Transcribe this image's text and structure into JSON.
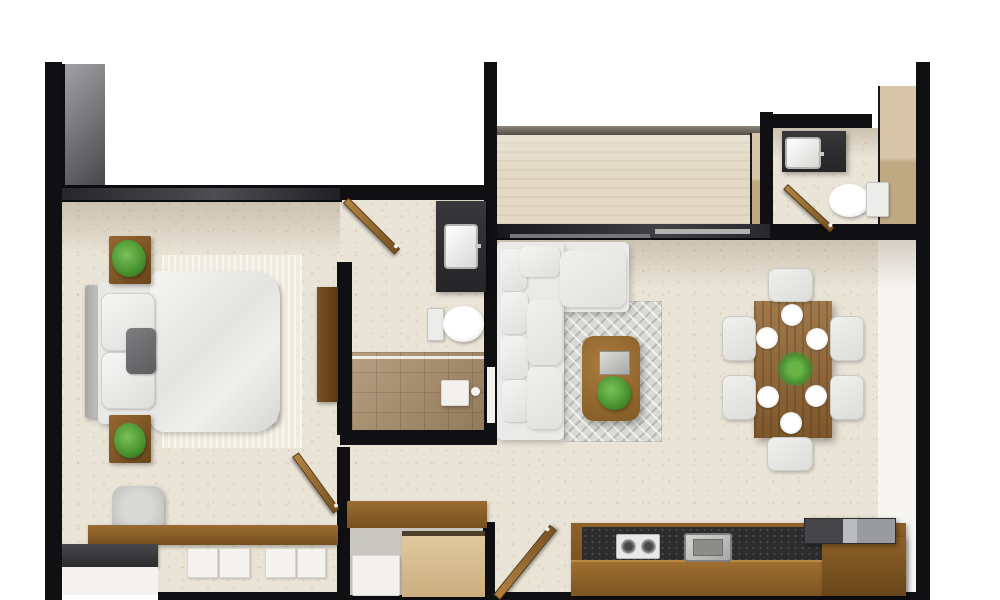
{
  "title": "apartment-floor-plan-top-view",
  "palette": {
    "background": "#ffffff",
    "wall_black": "#101013",
    "wall_gray_band": "#4d4d52",
    "floor_travertine": "#eae4d7",
    "terrace_floor": "#e3d9c6",
    "wood_door": "#a5762f",
    "wood_furniture": "#8f6229",
    "wood_cabinet_light": "#d7c19a",
    "counter_granite": "#2d2d2f",
    "vanity_charcoal": "#333336",
    "upholstery_white": "#eaeae8",
    "rug_gray": "#d9d9d5",
    "bed_rug_cream": "#f0ebdf",
    "shower_tile": "#a68b66",
    "plant_green": "#4c9632",
    "fixture_white": "#f2f1ee"
  },
  "rooms": [
    {
      "name": "bedroom",
      "contents": [
        "double-bed",
        "two-nightstands-with-plants",
        "media-console",
        "desk-with-chair",
        "drawer-unit",
        "dresser"
      ]
    },
    {
      "name": "master-bathroom",
      "contents": [
        "vanity-sink",
        "toilet",
        "walk-in-shower",
        "door"
      ]
    },
    {
      "name": "entry-corridor-closet",
      "contents": [
        "bench-console",
        "closet-cabinet",
        "storage-box",
        "entry-door",
        "bedroom-door"
      ]
    },
    {
      "name": "living-room",
      "contents": [
        "l-shaped-sofa",
        "area-rug",
        "coffee-table-with-plant-and-tray"
      ]
    },
    {
      "name": "dining-room",
      "contents": [
        "wood-table",
        "six-chairs",
        "six-plates",
        "plant-centerpiece"
      ]
    },
    {
      "name": "kitchen",
      "contents": [
        "counter-with-cooktop-and-sink",
        "appliance-block"
      ]
    },
    {
      "name": "powder-room",
      "contents": [
        "vanity-sink",
        "toilet",
        "door"
      ]
    },
    {
      "name": "terrace",
      "contents": []
    }
  ],
  "floorplan": {
    "canvas": {
      "width": 1000,
      "height": 600
    },
    "items": [
      {
        "name": "bedroom-floor",
        "cls": "floor",
        "rect": [
          62,
          195,
          278,
          400
        ]
      },
      {
        "name": "corridor-floor",
        "cls": "floor",
        "rect": [
          340,
          195,
          157,
          400
        ]
      },
      {
        "name": "living-floor",
        "cls": "floor",
        "rect": [
          497,
          235,
          421,
          360
        ]
      },
      {
        "name": "terrace-floor",
        "cls": "terrace",
        "rect": [
          497,
          133,
          263,
          94
        ]
      },
      {
        "name": "powder-floor",
        "cls": "floor",
        "rect": [
          772,
          128,
          106,
          100
        ]
      },
      {
        "name": "powder-right-panel",
        "cls": "panel-wood",
        "rect": [
          878,
          86,
          38,
          148
        ]
      },
      {
        "name": "entry-floor",
        "cls": "whitefloor",
        "rect": [
          878,
          234,
          38,
          360
        ]
      },
      {
        "name": "bedroom-wall-shade",
        "cls": "shade",
        "rect": [
          62,
          202,
          278,
          55
        ]
      },
      {
        "name": "living-wall-shade",
        "cls": "shade",
        "rect": [
          497,
          239,
          421,
          50
        ]
      },
      {
        "name": "powder-wall-shade",
        "cls": "shade",
        "rect": [
          772,
          128,
          106,
          30
        ]
      },
      {
        "name": "left-wall",
        "cls": "wall",
        "rect": [
          45,
          62,
          17,
          538
        ]
      },
      {
        "name": "wardrobe-gray-panel",
        "cls": "graypanel",
        "rect": [
          62,
          64,
          43,
          126
        ]
      },
      {
        "name": "bedroom-top-wall",
        "cls": "wallband",
        "rect": [
          62,
          185,
          280,
          17
        ]
      },
      {
        "name": "bath-top-wall",
        "cls": "wall",
        "rect": [
          340,
          185,
          157,
          15
        ]
      },
      {
        "name": "center-wall",
        "cls": "wall",
        "rect": [
          484,
          62,
          13,
          383
        ]
      },
      {
        "name": "wall-niche",
        "cls": "niche",
        "rect": [
          487,
          367,
          8,
          56
        ]
      },
      {
        "name": "terrace-parapet",
        "cls": "parapet",
        "rect": [
          497,
          126,
          263,
          9
        ]
      },
      {
        "name": "terrace-right-wood",
        "cls": "panel-wood",
        "rect": [
          750,
          133,
          10,
          94
        ]
      },
      {
        "name": "terrace-right-wall",
        "cls": "wall",
        "rect": [
          760,
          112,
          13,
          125
        ]
      },
      {
        "name": "living-top-wall",
        "cls": "wallband2",
        "rect": [
          497,
          224,
          273,
          16
        ]
      },
      {
        "name": "window-line-1",
        "cls": "winline",
        "rect": [
          655,
          229,
          95,
          5
        ]
      },
      {
        "name": "window-line-2",
        "cls": "winline2",
        "rect": [
          510,
          234,
          140,
          4
        ]
      },
      {
        "name": "powder-top-wall",
        "cls": "wall",
        "rect": [
          770,
          114,
          102,
          14
        ]
      },
      {
        "name": "powder-bottom-wall",
        "cls": "wall",
        "rect": [
          770,
          224,
          160,
          16
        ]
      },
      {
        "name": "right-wall",
        "cls": "wall",
        "rect": [
          916,
          62,
          14,
          538
        ]
      },
      {
        "name": "bottom-wall",
        "cls": "wall",
        "rect": [
          158,
          592,
          772,
          8
        ]
      },
      {
        "name": "bath-left-wall",
        "cls": "wall",
        "rect": [
          337,
          262,
          15,
          173
        ]
      },
      {
        "name": "bath-bottom-wall",
        "cls": "wall",
        "rect": [
          340,
          430,
          157,
          15
        ]
      },
      {
        "name": "corridor-pillar",
        "cls": "wall",
        "rect": [
          337,
          447,
          13,
          78
        ]
      },
      {
        "name": "closet-left-wall",
        "cls": "wall",
        "rect": [
          337,
          522,
          13,
          78
        ]
      },
      {
        "name": "closet-right-wall",
        "cls": "wall",
        "rect": [
          482,
          522,
          13,
          78
        ]
      },
      {
        "name": "shower-floor",
        "cls": "shower",
        "rect": [
          352,
          352,
          132,
          78
        ]
      },
      {
        "name": "shower-glass",
        "cls": "glass",
        "rect": [
          352,
          356,
          132,
          3
        ]
      },
      {
        "name": "shower-seat",
        "cls": "whiteobj",
        "rect": [
          441,
          380,
          28,
          26
        ]
      },
      {
        "name": "shower-knob",
        "cls": "dot-white",
        "rect": [
          471,
          387,
          9,
          9
        ]
      },
      {
        "name": "bath-vanity",
        "cls": "darkunit",
        "rect": [
          436,
          201,
          50,
          91
        ]
      },
      {
        "name": "bath-sink",
        "cls": "sink",
        "rect": [
          444,
          224,
          34,
          45
        ]
      },
      {
        "name": "bath-toilet-tank",
        "cls": "tank",
        "rect": [
          427,
          308,
          17,
          33
        ]
      },
      {
        "name": "bath-toilet-bowl",
        "cls": "bowl",
        "rect": [
          443,
          306,
          41,
          36
        ]
      },
      {
        "name": "bed-rug",
        "cls": "bedrug",
        "rect": [
          162,
          255,
          140,
          193
        ]
      },
      {
        "name": "bed-headboard",
        "cls": "headboard",
        "rect": [
          85,
          285,
          15,
          133
        ]
      },
      {
        "name": "bed-mattress",
        "cls": "mattress",
        "rect": [
          98,
          282,
          180,
          142
        ]
      },
      {
        "name": "bed-duvet",
        "cls": "duvet",
        "rect": [
          150,
          271,
          130,
          161
        ]
      },
      {
        "name": "bed-pillow-1",
        "cls": "pillow",
        "rect": [
          101,
          293,
          54,
          58
        ]
      },
      {
        "name": "bed-pillow-2",
        "cls": "pillow",
        "rect": [
          101,
          352,
          54,
          57
        ]
      },
      {
        "name": "bed-accent-pillow",
        "cls": "pillow-gray",
        "rect": [
          126,
          328,
          30,
          46
        ]
      },
      {
        "name": "nightstand-top",
        "cls": "nstand",
        "rect": [
          109,
          236,
          42,
          48
        ]
      },
      {
        "name": "plant-top",
        "cls": "plant",
        "rect": [
          112,
          240,
          34,
          37
        ]
      },
      {
        "name": "nightstand-bottom",
        "cls": "nstand",
        "rect": [
          109,
          415,
          42,
          48
        ]
      },
      {
        "name": "plant-bottom",
        "cls": "plant",
        "rect": [
          114,
          423,
          32,
          35
        ]
      },
      {
        "name": "media-console",
        "cls": "console",
        "rect": [
          317,
          287,
          21,
          115
        ]
      },
      {
        "name": "bedroom-chair",
        "cls": "chair-gray",
        "rect": [
          112,
          486,
          52,
          49
        ]
      },
      {
        "name": "bedroom-desk",
        "cls": "wood-desk",
        "rect": [
          88,
          525,
          250,
          20
        ]
      },
      {
        "name": "drawer-1",
        "cls": "drawer",
        "rect": [
          187,
          548,
          31,
          30
        ]
      },
      {
        "name": "drawer-2",
        "cls": "drawer",
        "rect": [
          219,
          548,
          31,
          30
        ]
      },
      {
        "name": "drawer-3",
        "cls": "drawer",
        "rect": [
          265,
          548,
          31,
          30
        ]
      },
      {
        "name": "drawer-4",
        "cls": "drawer",
        "rect": [
          297,
          548,
          29,
          30
        ]
      },
      {
        "name": "dresser-top",
        "cls": "darktop",
        "rect": [
          62,
          544,
          96,
          23
        ]
      },
      {
        "name": "dresser-front",
        "cls": "whitefront",
        "rect": [
          62,
          567,
          96,
          28
        ]
      },
      {
        "name": "entry-bench",
        "cls": "wood-desk",
        "rect": [
          347,
          501,
          140,
          27
        ]
      },
      {
        "name": "closet-interior",
        "cls": "closetgray",
        "rect": [
          350,
          528,
          133,
          67
        ]
      },
      {
        "name": "closet-box",
        "cls": "whiteobj",
        "rect": [
          352,
          555,
          48,
          41
        ]
      },
      {
        "name": "closet-cabinet",
        "cls": "cabinet",
        "rect": [
          402,
          531,
          83,
          66
        ]
      },
      {
        "name": "living-rug",
        "cls": "rug",
        "rect": [
          564,
          301,
          98,
          141
        ]
      },
      {
        "name": "sofa-chaise",
        "cls": "sofa",
        "rect": [
          497,
          242,
          132,
          70
        ]
      },
      {
        "name": "sofa-body",
        "cls": "sofa",
        "rect": [
          497,
          242,
          67,
          198
        ]
      },
      {
        "name": "sofa-cushion-1",
        "cls": "cushion",
        "rect": [
          500,
          249,
          27,
          42
        ]
      },
      {
        "name": "sofa-cushion-2",
        "cls": "cushion",
        "rect": [
          501,
          292,
          27,
          42
        ]
      },
      {
        "name": "sofa-cushion-3",
        "cls": "cushion",
        "rect": [
          500,
          336,
          28,
          43
        ]
      },
      {
        "name": "sofa-cushion-4",
        "cls": "cushion",
        "rect": [
          502,
          380,
          28,
          42
        ]
      },
      {
        "name": "sofa-cushion-5",
        "cls": "cushion",
        "rect": [
          520,
          246,
          40,
          31
        ]
      },
      {
        "name": "sofa-chaise-cushion",
        "cls": "cushion-big",
        "rect": [
          560,
          251,
          66,
          56
        ]
      },
      {
        "name": "sofa-seat-1",
        "cls": "cushion-big",
        "rect": [
          527,
          300,
          35,
          65
        ]
      },
      {
        "name": "sofa-seat-2",
        "cls": "cushion-big",
        "rect": [
          527,
          367,
          35,
          62
        ]
      },
      {
        "name": "coffee-table",
        "cls": "ctable",
        "rect": [
          582,
          336,
          58,
          85
        ]
      },
      {
        "name": "coffee-tray",
        "cls": "tray",
        "rect": [
          599,
          351,
          31,
          24
        ]
      },
      {
        "name": "coffee-plant",
        "cls": "plant",
        "rect": [
          597,
          376,
          34,
          34
        ]
      },
      {
        "name": "dining-table",
        "cls": "dtable",
        "rect": [
          754,
          301,
          78,
          137
        ]
      },
      {
        "name": "dining-chair-top",
        "cls": "dchair",
        "rect": [
          768,
          268,
          45,
          34
        ]
      },
      {
        "name": "dining-chair-bottom",
        "cls": "dchair",
        "rect": [
          767,
          437,
          46,
          34
        ]
      },
      {
        "name": "dining-chair-left-1",
        "cls": "dchair",
        "rect": [
          722,
          316,
          34,
          45
        ]
      },
      {
        "name": "dining-chair-left-2",
        "cls": "dchair",
        "rect": [
          722,
          375,
          34,
          45
        ]
      },
      {
        "name": "dining-chair-right-1",
        "cls": "dchair",
        "rect": [
          830,
          316,
          34,
          45
        ]
      },
      {
        "name": "dining-chair-right-2",
        "cls": "dchair",
        "rect": [
          830,
          375,
          34,
          45
        ]
      },
      {
        "name": "plate-1",
        "cls": "plate",
        "rect": [
          781,
          304,
          22,
          22
        ]
      },
      {
        "name": "plate-2",
        "cls": "plate",
        "rect": [
          756,
          327,
          22,
          22
        ]
      },
      {
        "name": "plate-3",
        "cls": "plate",
        "rect": [
          806,
          328,
          22,
          22
        ]
      },
      {
        "name": "plate-4",
        "cls": "plate",
        "rect": [
          757,
          386,
          22,
          22
        ]
      },
      {
        "name": "plate-5",
        "cls": "plate",
        "rect": [
          805,
          385,
          22,
          22
        ]
      },
      {
        "name": "plate-6",
        "cls": "plate",
        "rect": [
          780,
          412,
          22,
          22
        ]
      },
      {
        "name": "dining-plant",
        "cls": "plant-sprig",
        "rect": [
          776,
          352,
          38,
          34
        ]
      },
      {
        "name": "kitchen-base",
        "cls": "wood-mid",
        "rect": [
          571,
          523,
          335,
          73
        ]
      },
      {
        "name": "kitchen-counter-top",
        "cls": "counterdark",
        "rect": [
          582,
          527,
          288,
          34
        ]
      },
      {
        "name": "kitchen-front",
        "cls": "wood-front",
        "rect": [
          571,
          560,
          252,
          36
        ]
      },
      {
        "name": "cooktop",
        "cls": "cooktop",
        "rect": [
          616,
          534,
          44,
          25
        ]
      },
      {
        "name": "burner-1",
        "cls": "burner",
        "rect": [
          621,
          539,
          15,
          15
        ]
      },
      {
        "name": "burner-2",
        "cls": "burner",
        "rect": [
          641,
          539,
          15,
          15
        ]
      },
      {
        "name": "kitchen-sink",
        "cls": "ksink",
        "rect": [
          684,
          533,
          48,
          29
        ]
      },
      {
        "name": "kitchen-island-wood",
        "cls": "wood-mid",
        "rect": [
          822,
          537,
          84,
          59
        ]
      },
      {
        "name": "kitchen-appliance",
        "cls": "appliance",
        "rect": [
          804,
          518,
          92,
          26
        ]
      },
      {
        "name": "powder-vanity",
        "cls": "darkunit",
        "rect": [
          782,
          131,
          64,
          41
        ]
      },
      {
        "name": "powder-sink",
        "cls": "sink",
        "rect": [
          785,
          137,
          36,
          32
        ]
      },
      {
        "name": "powder-toilet-bowl",
        "cls": "bowl",
        "rect": [
          829,
          184,
          41,
          33
        ]
      },
      {
        "name": "powder-toilet-tank",
        "cls": "tank",
        "rect": [
          866,
          182,
          23,
          35
        ]
      },
      {
        "name": "bathroom-door",
        "cls": "door",
        "rect": [
          335,
          222,
          73,
          8
        ],
        "rot": 45
      },
      {
        "name": "bedroom-door",
        "cls": "door",
        "rect": [
          281,
          479,
          70,
          8
        ],
        "rot": 54
      },
      {
        "name": "entry-door",
        "cls": "door",
        "rect": [
          480,
          558,
          90,
          9
        ],
        "rot": -51
      },
      {
        "name": "powder-door",
        "cls": "door",
        "rect": [
          777,
          205,
          64,
          7
        ],
        "rot": 43
      }
    ]
  }
}
